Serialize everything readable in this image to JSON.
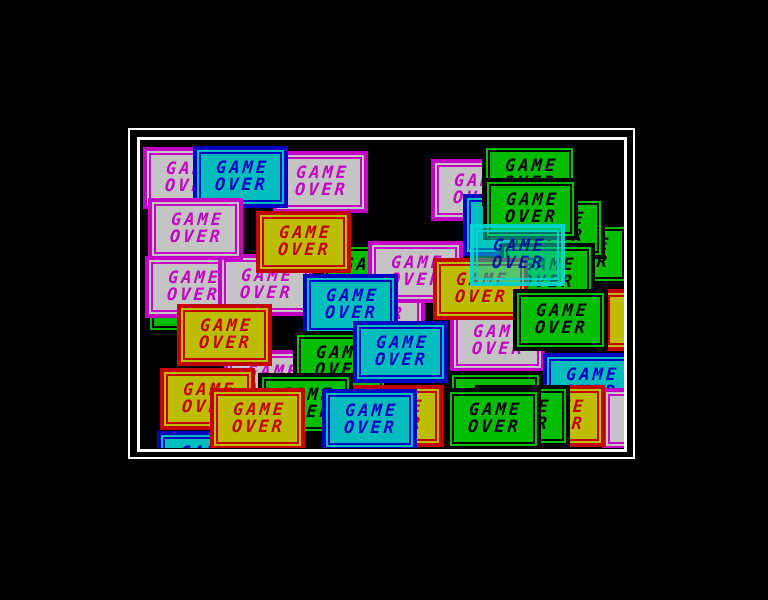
{
  "screen": {
    "background": "#000000",
    "frame_color": "#ffffff",
    "description": "game-over-screen"
  },
  "box_text": {
    "line1": "GAME",
    "line2": "OVER"
  },
  "schemes": {
    "gray": {
      "bg": "#c4c4c4",
      "border": "#c400c4",
      "text": "#c400c4"
    },
    "cyan": {
      "bg": "#00bdbd",
      "border": "#0000c2",
      "text": "#0000c2"
    },
    "yellow": {
      "bg": "#bdbd00",
      "border": "#c20000",
      "text": "#c20000"
    },
    "green": {
      "bg": "#00bd00",
      "border": "#000000",
      "text": "#000000"
    },
    "overlay": {
      "bg": "rgba(0,205,195,0.55)",
      "border": "rgba(0,215,215,0.85)",
      "text": "rgba(0,0,160,0.85)"
    }
  },
  "boxes": [
    {
      "x": 5,
      "y": 131,
      "scheme": "green"
    },
    {
      "x": 2,
      "y": 6,
      "scheme": "gray"
    },
    {
      "x": 132,
      "y": 10,
      "scheme": "gray"
    },
    {
      "x": 52,
      "y": 5,
      "scheme": "cyan"
    },
    {
      "x": 290,
      "y": 18,
      "scheme": "gray"
    },
    {
      "x": 322,
      "y": 53,
      "scheme": "cyan"
    },
    {
      "x": 394,
      "y": 82,
      "scheme": "green"
    },
    {
      "x": 369,
      "y": 56,
      "scheme": "green"
    },
    {
      "x": 359,
      "y": 102,
      "scheme": "green"
    },
    {
      "x": 461,
      "y": 148,
      "scheme": "yellow"
    },
    {
      "x": 341,
      "y": 3,
      "scheme": "green"
    },
    {
      "x": 342,
      "y": 37,
      "scheme": "green"
    },
    {
      "x": 179,
      "y": 102,
      "scheme": "green"
    },
    {
      "x": 189,
      "y": 134,
      "scheme": "gray"
    },
    {
      "x": 227,
      "y": 100,
      "scheme": "gray"
    },
    {
      "x": 4,
      "y": 115,
      "scheme": "gray"
    },
    {
      "x": 77,
      "y": 113,
      "scheme": "gray"
    },
    {
      "x": 7,
      "y": 57,
      "scheme": "gray"
    },
    {
      "x": 115,
      "y": 70,
      "scheme": "yellow"
    },
    {
      "x": 309,
      "y": 169,
      "scheme": "gray"
    },
    {
      "x": 292,
      "y": 117,
      "scheme": "yellow"
    },
    {
      "x": 162,
      "y": 133,
      "scheme": "cyan"
    },
    {
      "x": 83,
      "y": 209,
      "scheme": "gray"
    },
    {
      "x": 152,
      "y": 190,
      "scheme": "green"
    },
    {
      "x": 212,
      "y": 180,
      "scheme": "cyan"
    },
    {
      "x": 36,
      "y": 163,
      "scheme": "yellow"
    },
    {
      "x": 372,
      "y": 148,
      "scheme": "green"
    },
    {
      "x": 329,
      "y": 83,
      "scheme": "overlay"
    },
    {
      "x": 402,
      "y": 212,
      "scheme": "cyan"
    },
    {
      "x": 307,
      "y": 230,
      "scheme": "green"
    },
    {
      "x": 461,
      "y": 247,
      "scheme": "gray"
    },
    {
      "x": 369,
      "y": 244,
      "scheme": "yellow"
    },
    {
      "x": 334,
      "y": 244,
      "scheme": "green"
    },
    {
      "x": 305,
      "y": 247,
      "scheme": "green"
    },
    {
      "x": 207,
      "y": 244,
      "scheme": "yellow"
    },
    {
      "x": 117,
      "y": 232,
      "scheme": "green"
    },
    {
      "x": 19,
      "y": 227,
      "scheme": "yellow"
    },
    {
      "x": 16,
      "y": 290,
      "scheme": "cyan"
    },
    {
      "x": 69,
      "y": 247,
      "scheme": "yellow"
    },
    {
      "x": 181,
      "y": 248,
      "scheme": "cyan"
    }
  ]
}
